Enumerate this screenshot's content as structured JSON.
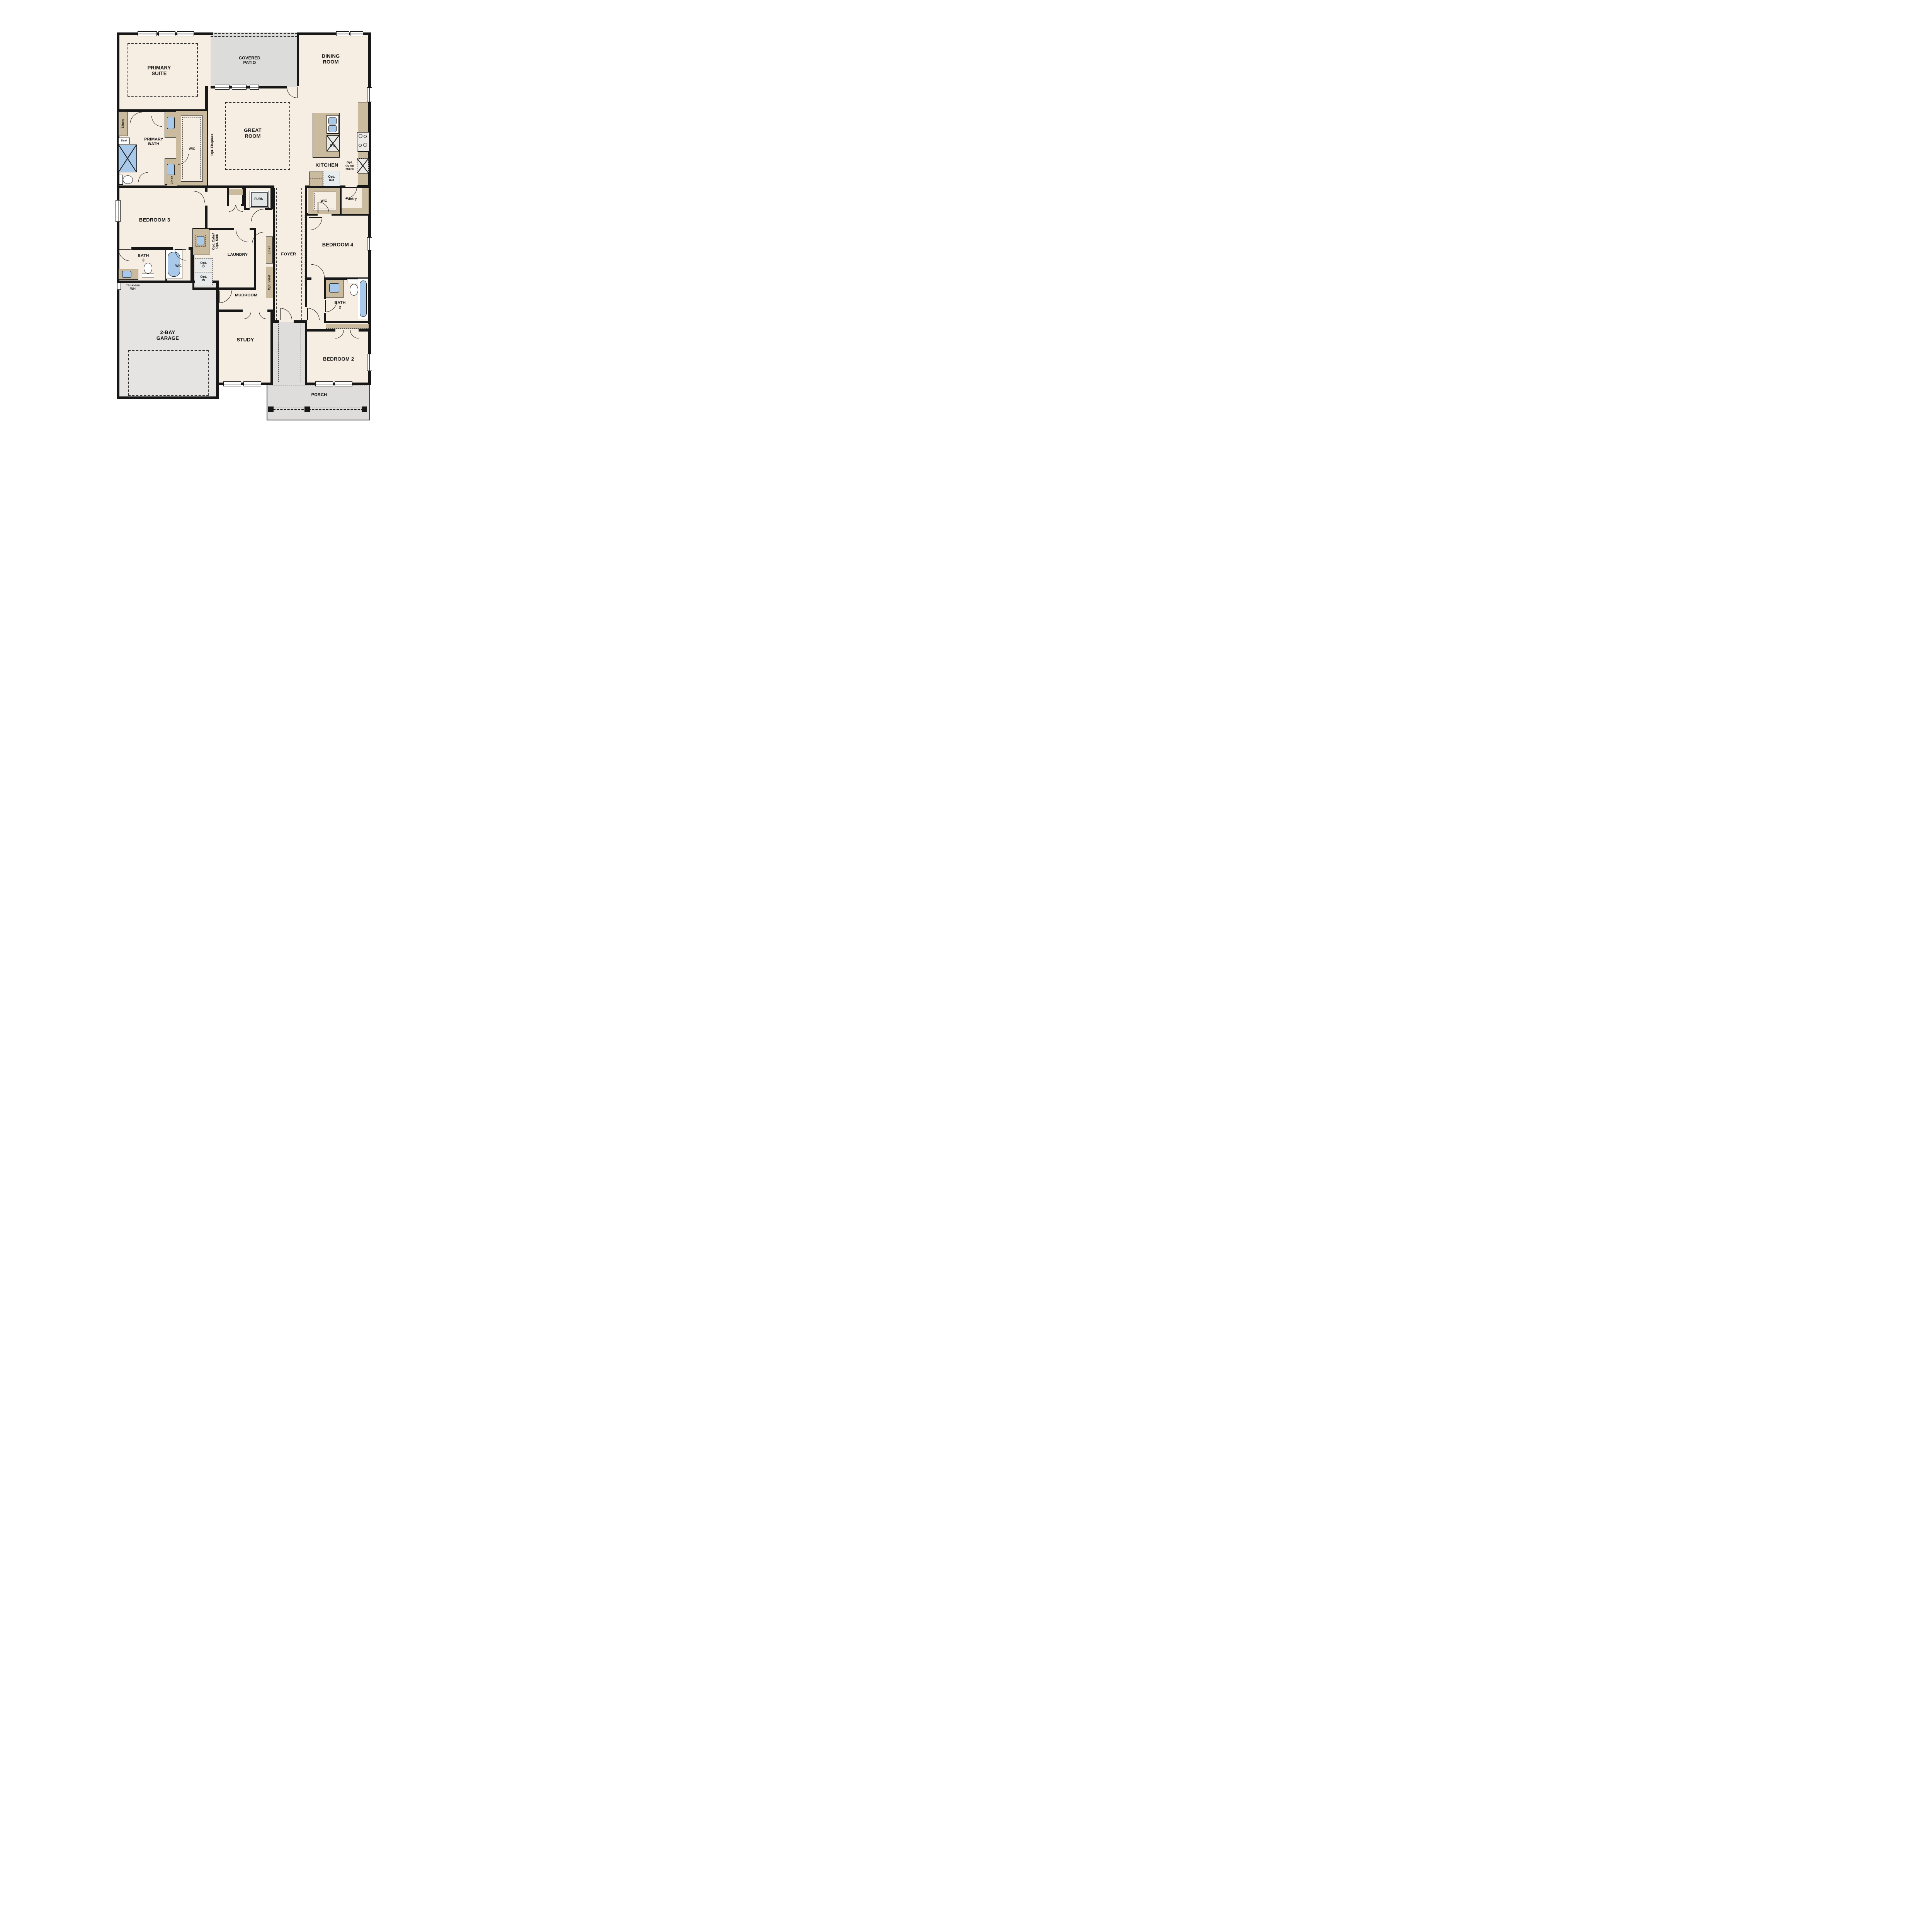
{
  "title": "Single-story floor plan",
  "colors": {
    "wall": "#171717",
    "interior_floor": "#f7eee3",
    "patio_gray": "#dcdcdb",
    "garage_gray": "#e5e4e2",
    "porch_gray": "#dedddb",
    "cabinet_tan": "#cbbb9e",
    "fixture_blue": "#a9c9ea",
    "appliance_gray": "#e4e8e8"
  },
  "labels": {
    "primary_suite": "PRIMARY\nSUITE",
    "covered_patio": "COVERED\nPATIO",
    "dining_room": "DINING\nROOM",
    "great_room": "GREAT\nROOM",
    "kitchen": "KITCHEN",
    "primary_bath": "PRIMARY\nBATH",
    "wic": "WIC",
    "bedroom3": "BEDROOM 3",
    "bath3": "BATH\n3",
    "laundry": "LAUNDRY",
    "mudroom": "MUDROOM",
    "study": "STUDY",
    "foyer": "FOYER",
    "garage": "2-BAY\nGARAGE",
    "porch": "PORCH",
    "bedroom4": "BEDROOM 4",
    "pantry": "Pantry",
    "bath2": "BATH\n2",
    "bedroom2": "BEDROOM 2",
    "linen": "Linen",
    "seat": "Seat",
    "opt_fireplace": "Opt. Fireplace",
    "furn": "FURN",
    "dw": "DW",
    "opt_ref": "Opt.\nRef",
    "opt_oven_micro": "Opt.\nOven/\nMicro",
    "opt_cabs_sink": "Opt. Cabs/\nOpt. Sink",
    "opt_d": "Opt.\nD",
    "opt_w": "Opt.\nW",
    "opt_valet": "Opt. Valet",
    "tankless_wh": "Tankless\nWH"
  }
}
